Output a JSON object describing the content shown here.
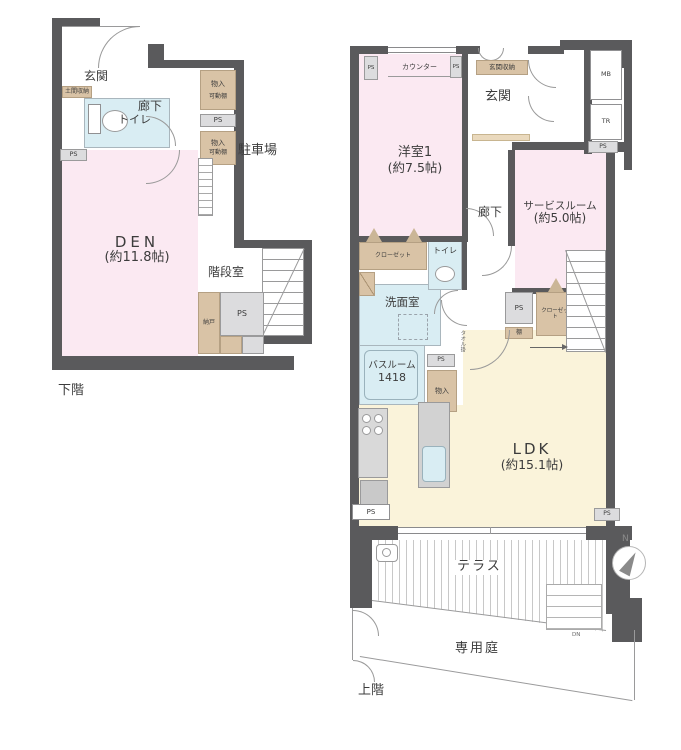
{
  "colors": {
    "wall": "#5a5a5c",
    "room-pink": "#fbe9f2",
    "room-cream": "#faf3da",
    "room-blue": "#d9edf3",
    "closet-beige": "#d9c3a6",
    "ps-gray": "#dcdcde",
    "hatch": "#c8c8c8",
    "text": "#3c3c3c"
  },
  "lower_floor": {
    "title": "下階",
    "labels": {
      "genkan": "玄関",
      "rouka": "廊下",
      "toilet": "トイレ",
      "doma_storage": "土間収納",
      "monoire": "物入",
      "movable_shelf": "可動棚",
      "ps": "PS",
      "den_name": "DEN",
      "den_size": "(約11.8帖)",
      "parking": "駐車場",
      "stair_room": "階段室",
      "nando": "納戸"
    }
  },
  "upper_floor": {
    "title": "上階",
    "labels": {
      "counter": "カウンター",
      "ps": "PS",
      "genkan_storage": "玄関収納",
      "genkan": "玄関",
      "mb": "MB",
      "tr": "TR",
      "room1_name": "洋室1",
      "room1_size": "(約7.5帖)",
      "service_name": "サービスルーム",
      "service_size": "(約5.0帖)",
      "rouka": "廊下",
      "closet": "クローゼット",
      "toilet": "トイレ",
      "senmen": "洗面室",
      "bath_name": "バスルーム",
      "bath_size": "1418",
      "monoire": "物入",
      "towel_rack": "タオル掛",
      "shelf": "棚",
      "refrigerator": "冷",
      "ldk_name": "LDK",
      "ldk_size": "(約15.1帖)",
      "terrace": "テラス",
      "garden": "専用庭",
      "north": "N",
      "down": "DN"
    }
  }
}
